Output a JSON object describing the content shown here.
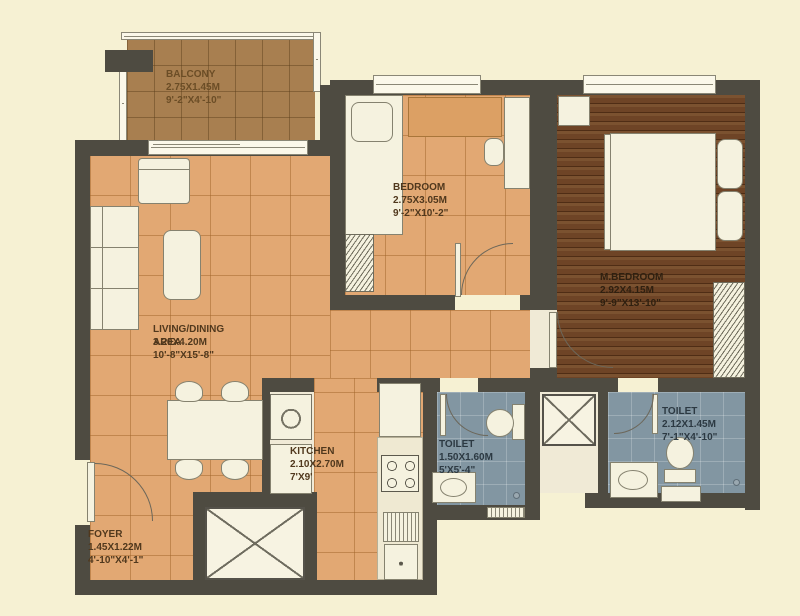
{
  "plan": {
    "type": "apartment-floor-plan",
    "rooms": [
      {
        "id": "balcony",
        "name": "BALCONY",
        "dim_m": "2.75X1.45M",
        "dim_ft": "9'-2\"X4'-10\""
      },
      {
        "id": "bedroom",
        "name": "BEDROOM",
        "dim_m": "2.75X3.05M",
        "dim_ft": "9'-2\"X10'-2\""
      },
      {
        "id": "master_bedroom",
        "name": "M.BEDROOM",
        "dim_m": "2.92X4.15M",
        "dim_ft": "9'-9\"X13'-10\""
      },
      {
        "id": "living_dining",
        "name": "LIVING/DINING AREA",
        "dim_m": "3.20X4.20M",
        "dim_ft": "10'-8\"X15'-8\""
      },
      {
        "id": "kitchen",
        "name": "KITCHEN",
        "dim_m": "2.10X2.70M",
        "dim_ft": "7'X9'"
      },
      {
        "id": "toilet_common",
        "name": "TOILET",
        "dim_m": "1.50X1.60M",
        "dim_ft": "5'X5'-4\""
      },
      {
        "id": "toilet_master",
        "name": "TOILET",
        "dim_m": "2.12X1.45M",
        "dim_ft": "7'-1\"X4'-10\""
      },
      {
        "id": "foyer",
        "name": "FOYER",
        "dim_m": "1.45X1.22M",
        "dim_ft": "4'-10\"X4'-1\""
      }
    ],
    "colors": {
      "background": "#f6f1d3",
      "wall": "#4e4b41",
      "floor_tile_tan": "#e2a873",
      "floor_balcony": "#a87f50",
      "floor_wood": "#6e4426",
      "floor_bath": "#8296a2",
      "fixture_white": "#f5f2df",
      "label_brown": "#50381d"
    },
    "fixtures": [
      "sofa",
      "armchair",
      "coffee-table",
      "dining-table",
      "dining-chair",
      "single-bed",
      "double-bed",
      "pillow",
      "wardrobe",
      "study-desk",
      "desk-chair",
      "nightstand",
      "dresser",
      "washing-machine",
      "utility-cabinet",
      "kitchen-cabinet",
      "gas-hob",
      "kitchen-sink",
      "wc-toilet",
      "washbasin",
      "duct-shaft",
      "door-swing",
      "window",
      "sliding-door",
      "vent",
      "floor-drain"
    ]
  }
}
